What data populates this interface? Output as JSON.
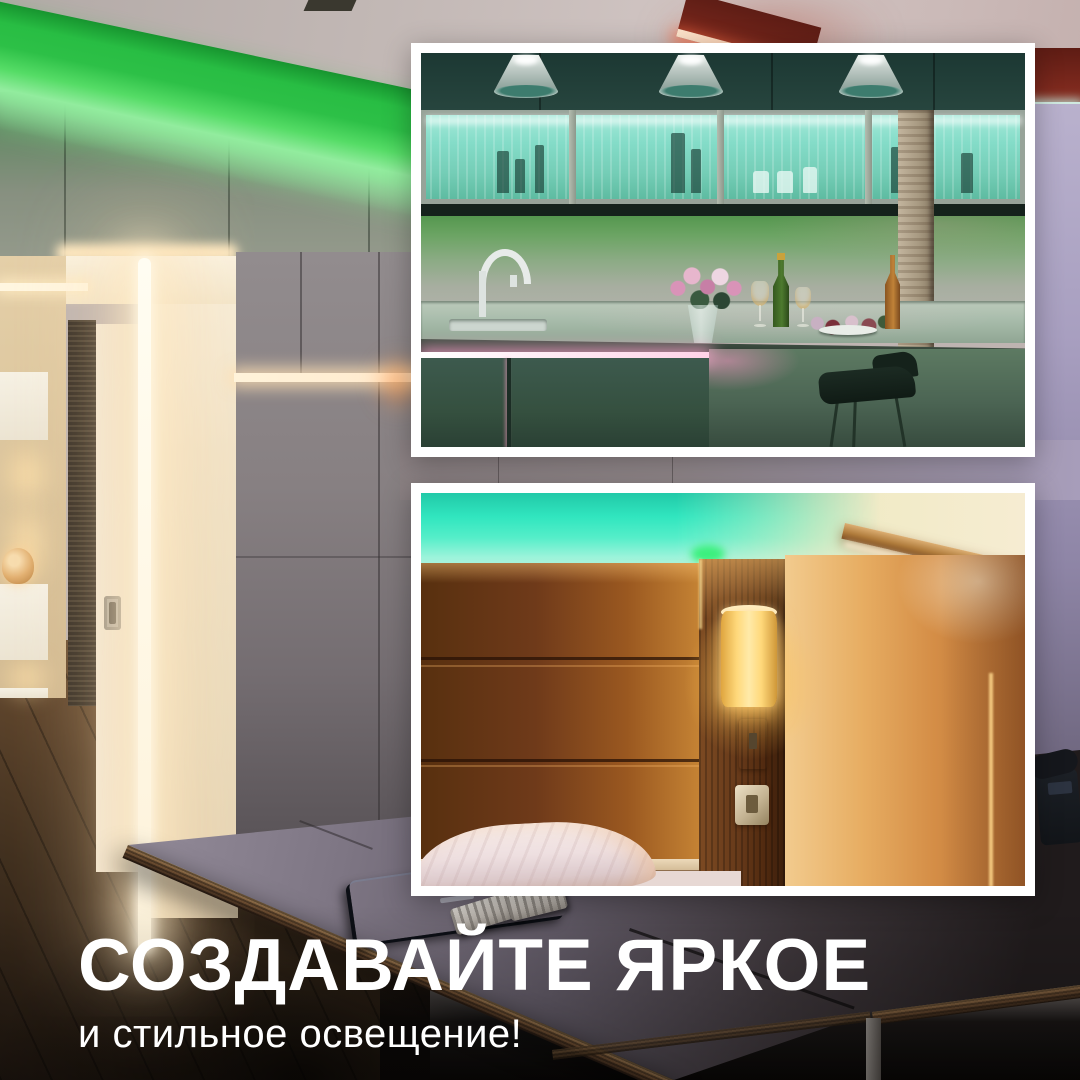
{
  "caption": {
    "title": "СОЗДАВАЙТЕ ЯРКОЕ",
    "subtitle": "и стильное освещение!"
  },
  "colors": {
    "led-green": "#2dc047",
    "led-cyan": "#31e6bf",
    "led-pink": "#ffd3e8",
    "led-red": "#7c281d",
    "warm-glow": "#ffe9c1",
    "lamp-amber": "#ffd87a",
    "text-white": "#ffffff"
  }
}
